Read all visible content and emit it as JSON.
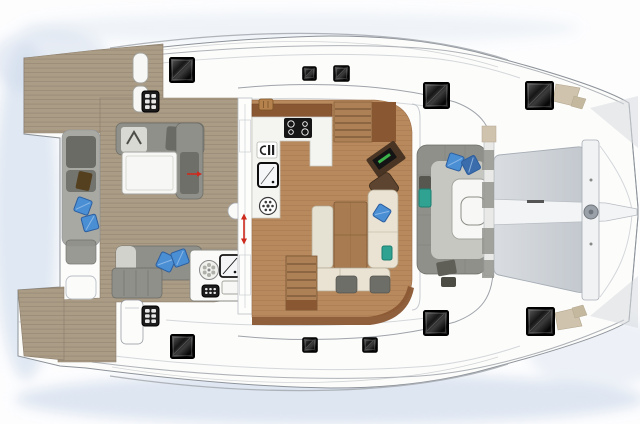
{
  "plan": {
    "type": "catamaran-deck-plan",
    "areas": [
      "swim-platform",
      "aft-cockpit",
      "wet-bar",
      "salon",
      "galley",
      "navigation-station",
      "dinette",
      "forward-cockpit",
      "trampoline",
      "port-hull-walkway",
      "starboard-hull-walkway",
      "foredeck"
    ]
  },
  "colors": {
    "background": "#fdfdfe",
    "water_shadow": "#c9d7e9",
    "deck_white": "#fcfcfb",
    "outline_gray": "#8d939a",
    "line_light": "#b9bec4",
    "teak": "#ab9c86",
    "teak_line": "#8a7d6a",
    "salon_wood": "#b8895c",
    "salon_wood_line": "#a1714a",
    "wood_dark": "#8a5733",
    "step_wood": "#ad8155",
    "step_line": "#6b4a2e",
    "table_wood": "#a87c50",
    "nav_brown": "#4a3524",
    "seat_brown": "#5d4430",
    "bench_gray": "#90908a",
    "bench_dark": "#6b6b65",
    "bench_mid": "#a9a9a3",
    "bench_light": "#c7c7c1",
    "cushion_light": "#d9d9d3",
    "sofa_cream": "#eae3d4",
    "sofa_cream_line": "#b6ad96",
    "furniture_white": "#f7f7f5",
    "panel_gray": "#b6b6b1",
    "pillow_blue": "#4a8ed4",
    "pillow_blue_dark": "#3b6cab",
    "pillow_edge": "#2c5e9e",
    "cushion_teal": "#2fa291",
    "cushion_teal_edge": "#1e7f70",
    "trampoline_light": "#d9dde1",
    "trampoline_dark": "#c3c8ce",
    "trampoline_edge": "#a6adb5",
    "hatch_black": "#101010",
    "accent_red": "#cf2a1e",
    "wedge_beige": "#cfc3ae",
    "wedge_beige_edge": "#b3a68c",
    "laptop_green": "#3cb24a"
  },
  "hatches": {
    "large": [
      [
        170,
        58,
        24
      ],
      [
        424,
        83,
        25
      ],
      [
        526,
        82,
        27
      ],
      [
        171,
        335,
        23
      ],
      [
        424,
        311,
        24
      ],
      [
        527,
        308,
        27
      ]
    ],
    "small": [
      [
        303,
        67,
        13
      ],
      [
        334,
        66,
        15
      ],
      [
        303,
        338,
        14
      ],
      [
        363,
        338,
        14
      ]
    ]
  },
  "vent_grids": [
    {
      "x": 142,
      "y": 91,
      "w": 17,
      "h": 21,
      "cols": 2,
      "rows": 3
    },
    {
      "x": 142,
      "y": 306,
      "w": 17,
      "h": 20,
      "cols": 2,
      "rows": 3
    },
    {
      "x": 202,
      "y": 285,
      "w": 17,
      "h": 12,
      "cols": 3,
      "rows": 2
    }
  ],
  "pillows": {
    "blue": [
      [
        83,
        206,
        15,
        20,
        0
      ],
      [
        90,
        223,
        15,
        -15,
        0
      ],
      [
        166,
        262,
        16,
        25,
        0
      ],
      [
        180,
        258,
        15,
        -20,
        0
      ],
      [
        455,
        162,
        15,
        18,
        0
      ],
      [
        471,
        165,
        15,
        -28,
        1
      ],
      [
        382,
        213,
        14,
        32,
        0
      ]
    ],
    "teal": [
      [
        419,
        189,
        12,
        18
      ],
      [
        382,
        246,
        10,
        14
      ]
    ]
  },
  "icons": [
    "stove-burners-icon",
    "sink-faucet-icon",
    "refrigerator-icon",
    "washing-machine-icon",
    "grill-burner-icon",
    "ice-box-icon",
    "vent-grid-icon",
    "deck-hatch",
    "windlass-icon",
    "nav-laptop-icon",
    "door-swing-arrow",
    "direction-arrow"
  ]
}
